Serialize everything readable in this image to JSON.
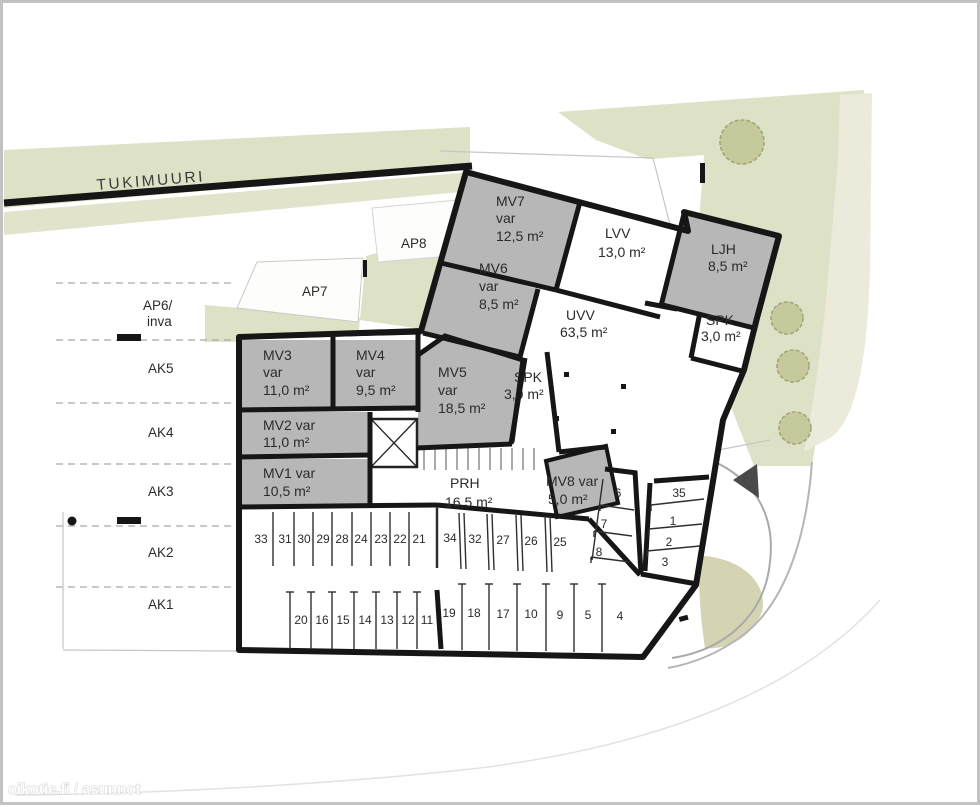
{
  "watermark": "oikotie.fi / asunnot",
  "site": {
    "retaining_wall_label": "TUKIMUURI",
    "outdoor_spots": {
      "ap6_line1": "AP6/",
      "ap6_line2": "inva",
      "ap7": "AP7",
      "ap8": "AP8",
      "ak": [
        "AK5",
        "AK4",
        "AK3",
        "AK2",
        "AK1"
      ]
    }
  },
  "rooms": {
    "mv7": {
      "name": "MV7",
      "type": "var",
      "area": "12,5 m²"
    },
    "lvv": {
      "name": "LVV",
      "area": "13,0 m²"
    },
    "ljh": {
      "name": "LJH",
      "area": "8,5 m²"
    },
    "spk_upper": {
      "name": "SPK",
      "area": "3,0 m²"
    },
    "mv6": {
      "name": "MV6",
      "type": "var",
      "area": "8,5 m²"
    },
    "uvv": {
      "name": "UVV",
      "area": "63,5 m²"
    },
    "mv5": {
      "name": "MV5",
      "type": "var",
      "area": "18,5 m²"
    },
    "spk_mid": {
      "name": "SPK",
      "area": "3,0 m²"
    },
    "mv3": {
      "name": "MV3",
      "type": "var",
      "area": "11,0 m²"
    },
    "mv4": {
      "name": "MV4",
      "type": "var",
      "area": "9,5 m²"
    },
    "mv2": {
      "name": "MV2 var",
      "area": "11,0 m²"
    },
    "mv1": {
      "name": "MV1 var",
      "area": "10,5 m²"
    },
    "prh": {
      "name": "PRH",
      "area": "16,5 m²"
    },
    "mv8": {
      "name": "MV8 var",
      "area": "5,0 m²"
    }
  },
  "parking": {
    "row_upper_left": [
      "33",
      "31",
      "30",
      "29",
      "28",
      "24",
      "23",
      "22",
      "21"
    ],
    "row_upper_right": [
      "34",
      "32",
      "27",
      "26",
      "25"
    ],
    "row_lower_left": [
      "20",
      "16",
      "15",
      "14",
      "13",
      "12",
      "11"
    ],
    "row_lower_right": [
      "19",
      "18",
      "17",
      "10",
      "9",
      "5",
      "4"
    ],
    "stair_side": [
      "6",
      "7",
      "8"
    ],
    "right_side": [
      "35",
      "1",
      "2",
      "3"
    ]
  }
}
